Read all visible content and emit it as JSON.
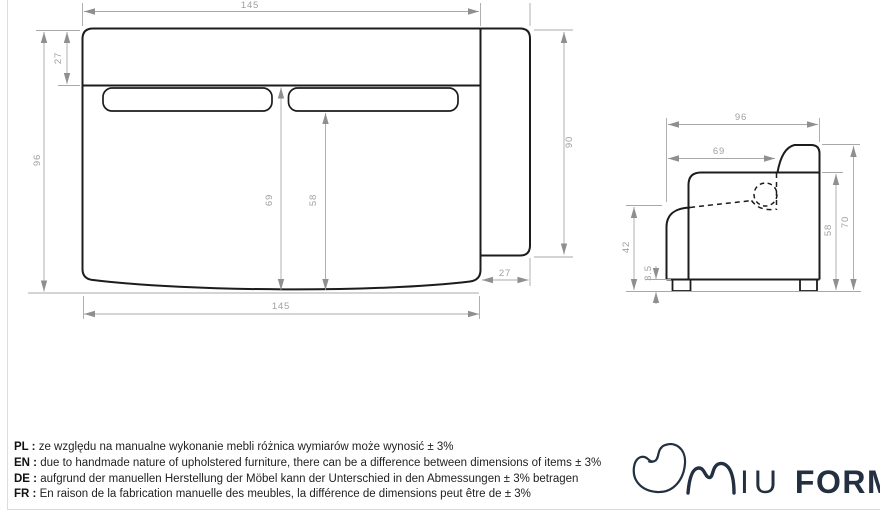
{
  "front_view": {
    "dims": {
      "width_top": "145",
      "height_total": "96",
      "backrest_top": "27",
      "seat_to_seam": "69",
      "seat_to_cushion": "58",
      "side_panel_height": "90",
      "side_panel_depth": "27",
      "width_bottom": "145"
    }
  },
  "side_view": {
    "dims": {
      "depth_total": "96",
      "seat_depth": "69",
      "armrest_height": "42",
      "leg_height": "3.5",
      "seat_back_height": "58",
      "backrest_height": "70"
    }
  },
  "notes": [
    {
      "label": "PL :",
      "text": "ze względu na manualne wykonanie mebli różnica wymiarów może wynosić ± 3%"
    },
    {
      "label": "EN :",
      "text": "due to handmade nature of upholstered furniture, there can be a difference between dimensions of items ± 3%"
    },
    {
      "label": "DE :",
      "text": "aufgrund der manuellen Herstellung der Möbel kann der Unterschied in den Abmessungen ± 3% betragen"
    },
    {
      "label": "FR :",
      "text": "En raison de la fabrication manuelle des meubles, la différence de dimensions peut être de ± 3%"
    }
  ],
  "logo": {
    "iu": "IU",
    "form": "FORM",
    "registered": "®"
  },
  "colors": {
    "outline": "#1c1c1c",
    "dimension": "#a8a8a8",
    "logo": "#233041",
    "frame": "#dcdcdc"
  }
}
